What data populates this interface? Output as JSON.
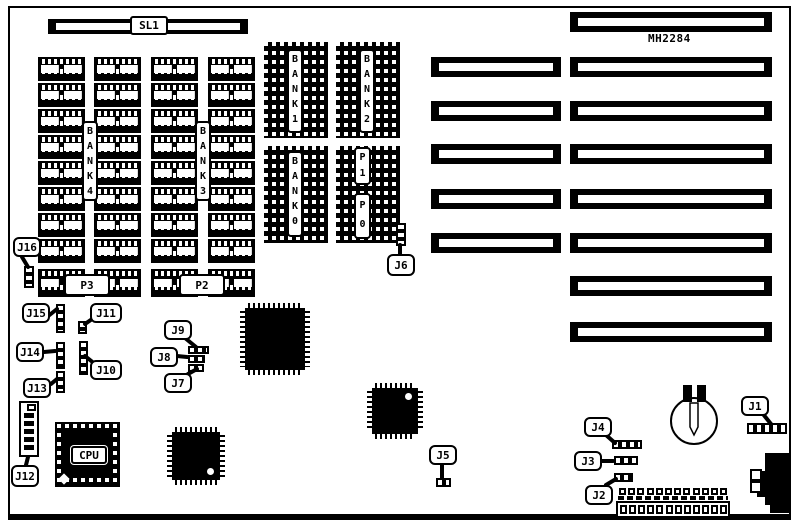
{
  "board": {
    "slot_connector_label": "SL1",
    "board_id_label": "MH2284",
    "cpu_label": "CPU",
    "bank_labels": {
      "bank4": "BANK4",
      "bank3": "BANK3",
      "bank1": "BANK1",
      "bank2": "BANK2",
      "bank0": "BANK0"
    },
    "power_labels": {
      "p3": "P3",
      "p2": "P2",
      "p1": "P1",
      "p0": "P0"
    },
    "jumper_labels": {
      "j1": "J1",
      "j2": "J2",
      "j3": "J3",
      "j4": "J4",
      "j5": "J5",
      "j6": "J6",
      "j7": "J7",
      "j8": "J8",
      "j9": "J9",
      "j10": "J10",
      "j11": "J11",
      "j12": "J12",
      "j13": "J13",
      "j14": "J14",
      "j15": "J15",
      "j16": "J16"
    }
  },
  "colors": {
    "ink": "#000000",
    "paper": "#ffffff"
  }
}
